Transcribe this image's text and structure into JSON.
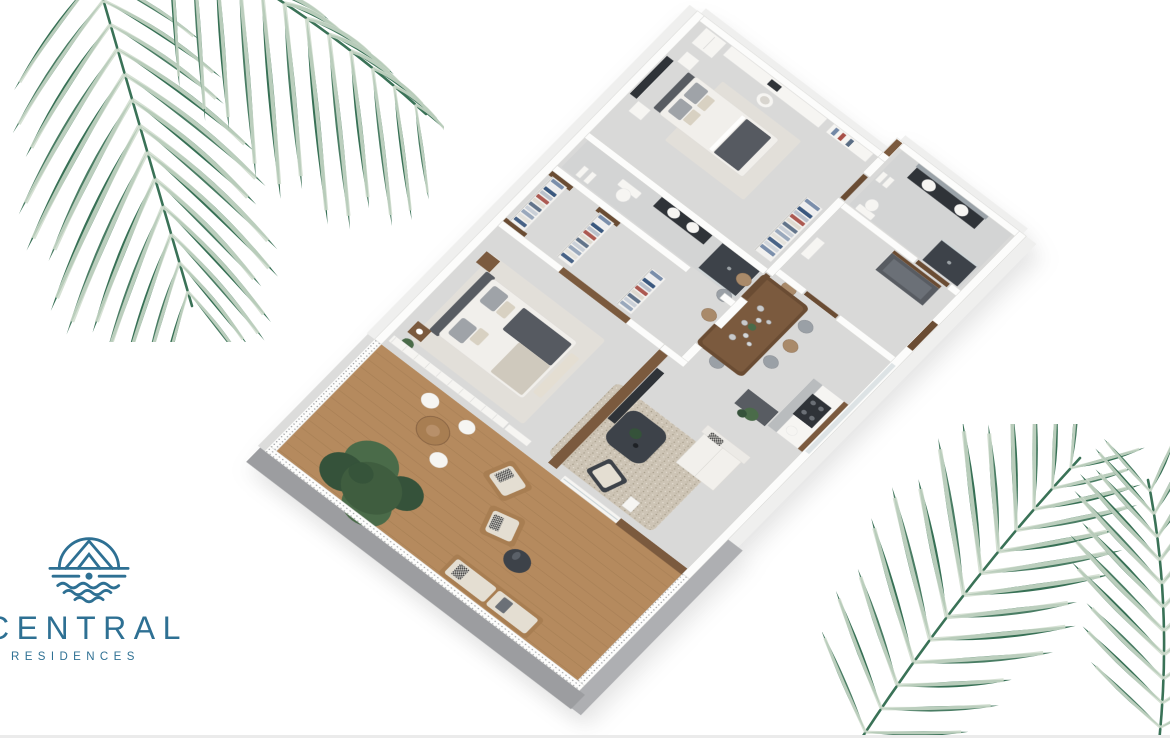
{
  "page": {
    "width": 1170,
    "height": 738,
    "background": "#ffffff"
  },
  "logo": {
    "brand": "CENTRAL",
    "subtitle": "RESIDENCES",
    "icon": "house-over-waves-icon",
    "color": "#2e7093"
  },
  "palette": {
    "brand": "#2e7093",
    "palm_dark": "#2f6a4e",
    "palm_mid": "#43785e",
    "palm_light": "#cfdccc",
    "wall_white": "#fcfcfb",
    "wall_edge": "#d8d8d5",
    "outer_gray": "#9c9da0",
    "outer_gray_light": "#aeafb2",
    "outer_white": "#efefee",
    "floor": "#d9d9d8",
    "floor_bath": "#d3d4d4",
    "deck": "#b58a5e",
    "deck_line": "#a0794f",
    "wood": "#7b5a3e",
    "wood_dark": "#6a4c33",
    "wood_light": "#a87e52",
    "dark_furn": "#3d4249",
    "dark_panel": "#2f3338",
    "gray_furn": "#585c62",
    "cushion": "#e4ded2",
    "rug": "#e2dfd9",
    "gravel": "#cdc4b5",
    "white_furn": "#f6f5f2",
    "bed_white": "#f1efeb",
    "throw": "#565a61",
    "pillow_gray": "#9fa3a8",
    "pillow_beige": "#d8d1c2",
    "green_dark": "#35523a",
    "green_mid": "#4a6b49",
    "glass": "#cdd6d8",
    "chair_tan": "#a98a6a",
    "chair_gray": "#9aa0a6"
  },
  "clothes_colors": [
    "#7388a6",
    "#ececee",
    "#2f4f78",
    "#b6bec9",
    "#a85048",
    "#ddd8ce",
    "#5a6d84",
    "#c7cdd6",
    "#93a3b8",
    "#e3e0da",
    "#3d5a80",
    "#cfd4da"
  ],
  "floorplan": {
    "type": "axonometric-3d-floor-plan-render",
    "rooms": [
      {
        "name": "bedroom-2",
        "furniture": [
          "double-bed",
          "wall-art-tv",
          "nightstands",
          "desk",
          "desk-chair",
          "dresser",
          "shelf",
          "wardrobe-rack",
          "rug"
        ]
      },
      {
        "name": "bathroom-1",
        "furniture": [
          "toilet",
          "vanity-sink",
          "shower",
          "towels"
        ]
      },
      {
        "name": "walk-in-closet",
        "furniture": [
          "clothes-rack",
          "clothes-rack",
          "clothes-rack"
        ]
      },
      {
        "name": "master-bedroom",
        "furniture": [
          "king-bed",
          "headboard",
          "nightstands",
          "flowers",
          "rug",
          "tv-console",
          "window-curtains",
          "plant"
        ]
      },
      {
        "name": "dining-room",
        "furniture": [
          "dining-table",
          "dining-chairs-x8",
          "pendant-glass-lights",
          "centerpiece"
        ]
      },
      {
        "name": "kitchen",
        "furniture": [
          "counter",
          "cooktop",
          "sink",
          "tall-cabinet",
          "plant"
        ]
      },
      {
        "name": "living-room",
        "furniture": [
          "gravel-rug",
          "coffee-table",
          "plant-vase",
          "armchair",
          "sofa",
          "sliding-glass-door"
        ]
      },
      {
        "name": "bathroom-2",
        "furniture": [
          "double-vanity",
          "mirror",
          "toilet",
          "shower",
          "towel-shelf"
        ]
      },
      {
        "name": "entry-hall",
        "furniture": [
          "storage-closet",
          "entrance-door"
        ]
      },
      {
        "name": "terrace",
        "furniture": [
          "wood-deck",
          "tree",
          "round-dining-table",
          "terrace-chairs",
          "lounge-chair",
          "lounge-chair",
          "round-coffee-table",
          "bench-sofa",
          "lattice-railing",
          "wood-privacy-wall"
        ]
      }
    ]
  },
  "decor": {
    "top_left": "watercolor-palm-frond",
    "bottom_right": "watercolor-palm-fronds"
  }
}
